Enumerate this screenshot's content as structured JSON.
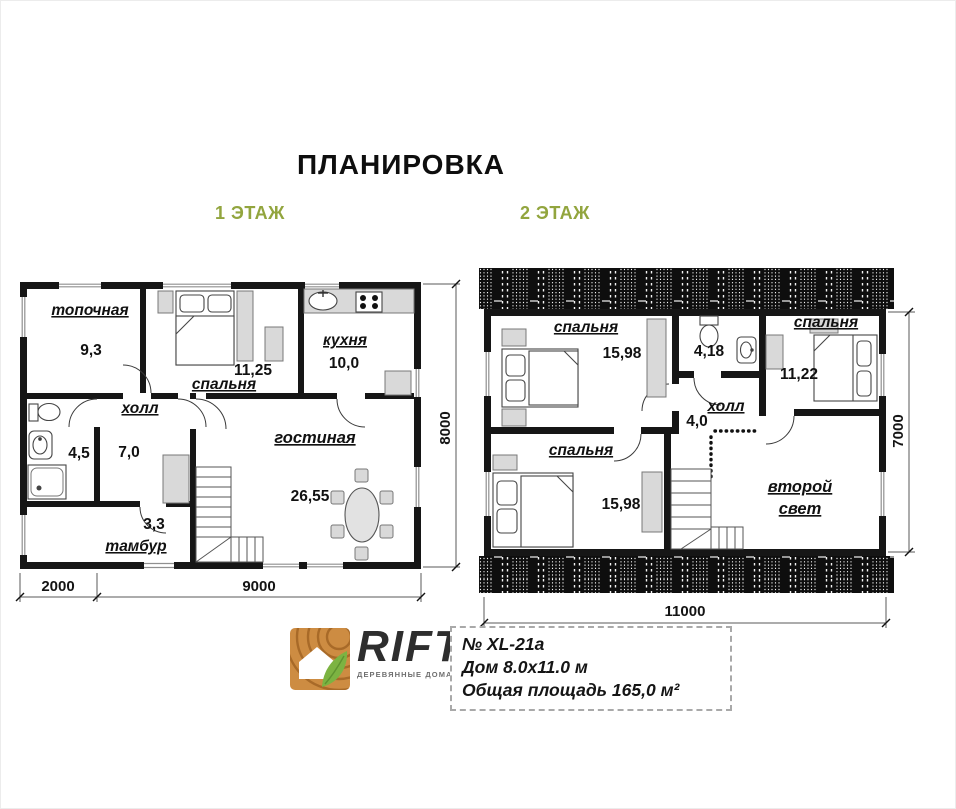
{
  "header": {
    "title": "ПЛАНИРОВКА"
  },
  "floor1": {
    "label": "1 ЭТАЖ",
    "rooms": {
      "boiler": {
        "name": "топочная",
        "area": "9,3"
      },
      "bedroom": {
        "name": "спальня",
        "area": "11,25"
      },
      "kitchen": {
        "name": "кухня",
        "area": "10,0"
      },
      "hall": {
        "name": "холл",
        "area": "7,0"
      },
      "bathroom": {
        "area": "4,5"
      },
      "vestibule": {
        "name": "тамбур",
        "area": "3,3"
      },
      "living": {
        "name": "гостиная",
        "area": "26,55"
      }
    },
    "dims": {
      "left": "2000",
      "main": "9000",
      "side": "8000"
    }
  },
  "floor2": {
    "label": "2 ЭТАЖ",
    "rooms": {
      "bedroom1": {
        "name": "спальня",
        "area": "15,98"
      },
      "bathroom": {
        "area": "4,18"
      },
      "bedroom2": {
        "name": "спальня",
        "area": "11,22"
      },
      "hall": {
        "name": "холл",
        "area": "4,0"
      },
      "bedroom3": {
        "name": "спальня",
        "area": "15,98"
      },
      "void": {
        "line1": "второй",
        "line2": "свет"
      }
    },
    "dims": {
      "width": "11000",
      "side": "7000"
    }
  },
  "footer": {
    "brand": "RIFT",
    "tagline": "ДЕРЕВЯННЫЕ ДОМА И БАНИ",
    "project": "№ XL-21a",
    "size": "Дом 8.0х11.0 м",
    "area": "Общая площадь 165,0 м²"
  },
  "colors": {
    "accent": "#92a53e",
    "wall": "#161616",
    "furniture": "#d9d9d9"
  }
}
